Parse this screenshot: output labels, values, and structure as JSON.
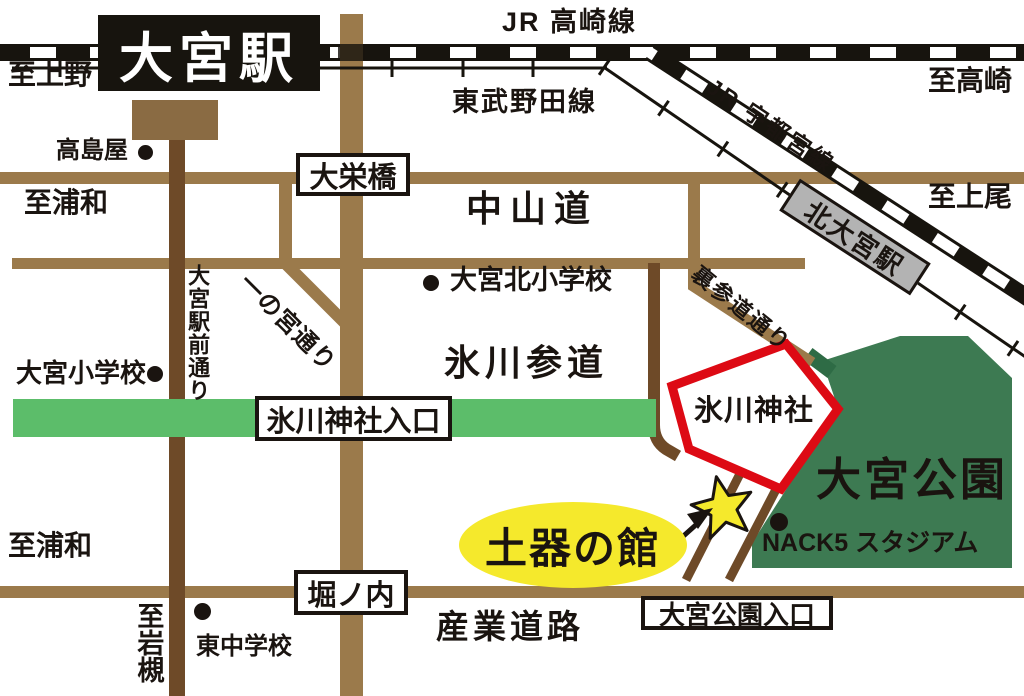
{
  "map_title": "大宮駅・氷川神社周辺マップ",
  "colors": {
    "road_brown": "#9b7a4b",
    "road_dark_brown": "#6e4a28",
    "rail_black": "#17140e",
    "sando_green": "#5cbd6a",
    "park_green": "#3d7a52",
    "shrine_red": "#dd0a14",
    "highlight_yellow": "#f5e92c",
    "station_gray": "#b3b3b3"
  },
  "stations": {
    "omiya": "大宮駅",
    "kita_omiya": "北大宮駅"
  },
  "rail_lines": {
    "jr_takasaki": "JR 高崎線",
    "tobu_noda": "東武野田線",
    "jr_utsunomiya": "JR 宇都宮線"
  },
  "directions": {
    "to_ueno": "至上野",
    "to_takasaki": "至高崎",
    "to_ageo": "至上尾",
    "to_urawa_top": "至浦和",
    "to_urawa_bottom": "至浦和",
    "to_iwatsuki": "至岩槻"
  },
  "roads": {
    "nakasendo": "中山道",
    "daieibashi": "大栄橋",
    "ichinomiya_dori": "一の宮通り",
    "ekimae_dori": "大宮駅前通り",
    "hikawa_sando": "氷川参道",
    "urasando_dori": "裏参道通り",
    "horinouchi": "堀ノ内",
    "sangyo_doro": "産業道路"
  },
  "landmarks": {
    "takashimaya": "高島屋",
    "omiya_kita_elementary": "大宮北小学校",
    "omiya_elementary": "大宮小学校",
    "hikawa_entrance": "氷川神社入口",
    "hikawa_shrine": "氷川神社",
    "omiya_park": "大宮公園",
    "park_entrance": "大宮公園入口",
    "nack5_stadium": "NACK5 スタジアム",
    "doki_no_yakata": "土器の館",
    "higashi_junior_high": "東中学校"
  }
}
